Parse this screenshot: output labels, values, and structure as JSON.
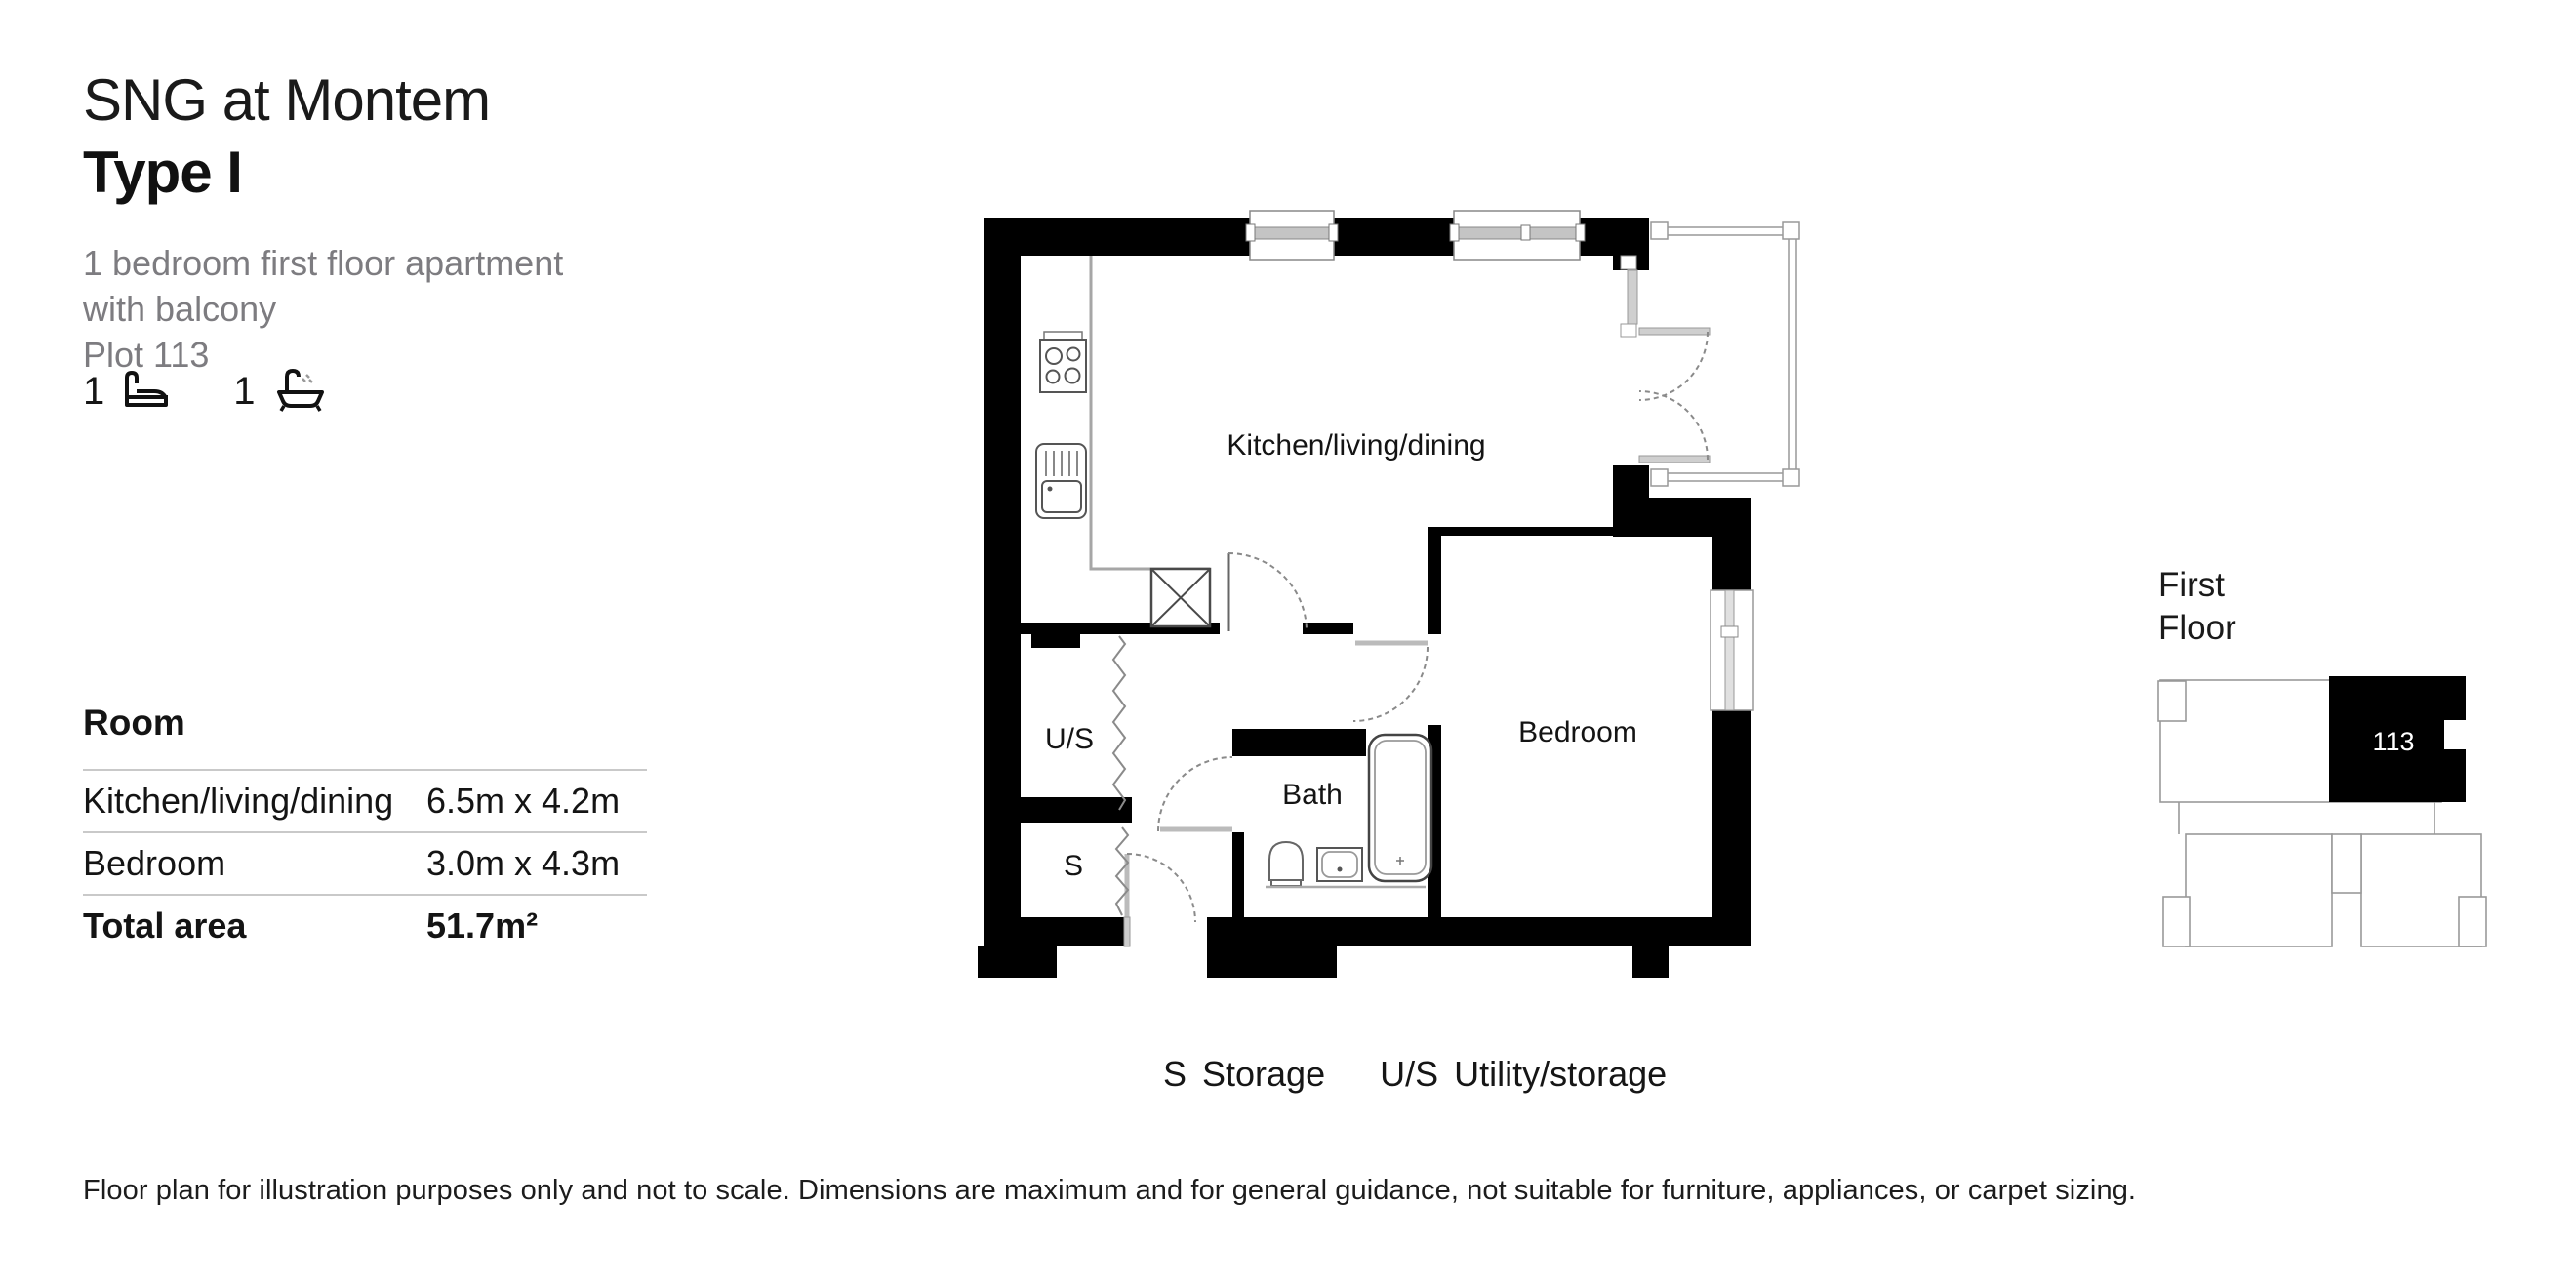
{
  "header": {
    "development": "SNG at Montem",
    "type_label": "Type I",
    "description_line1": "1 bedroom first floor apartment",
    "description_line2": "with balcony",
    "plot": "Plot 113",
    "bed_count": "1",
    "bath_count": "1"
  },
  "room_table": {
    "header": "Room",
    "rows": [
      {
        "room": "Kitchen/living/dining",
        "dims": "6.5m x 4.2m"
      },
      {
        "room": "Bedroom",
        "dims": "3.0m x 4.3m"
      }
    ],
    "total_label": "Total area",
    "total_value": "51.7m²"
  },
  "floor_plan": {
    "labels": {
      "kitchen": "Kitchen/living/dining",
      "bedroom": "Bedroom",
      "bath": "Bath",
      "utility": "U/S",
      "storage": "S"
    }
  },
  "legend": {
    "storage_abbr": "S",
    "storage_label": "Storage",
    "utility_abbr": "U/S",
    "utility_label": "Utility/storage"
  },
  "minimap": {
    "floor_line1": "First",
    "floor_line2": "Floor",
    "unit_number": "113"
  },
  "disclaimer": "Floor plan for illustration purposes only and not to scale. Dimensions are maximum and for general guidance, not suitable for furniture, appliances, or carpet sizing.",
  "colors": {
    "wall": "#000000",
    "thin_line": "#999999",
    "text_gray": "#7d7c80",
    "unit_highlight": "#000000"
  }
}
